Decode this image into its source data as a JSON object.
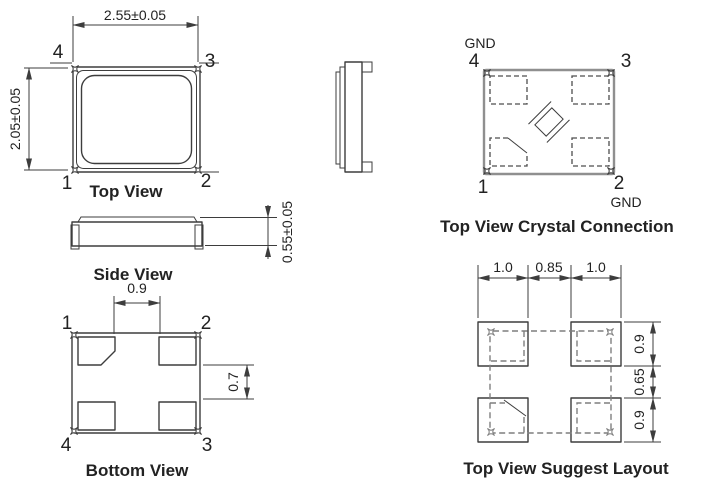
{
  "colors": {
    "line": "#3d3d3d",
    "gray_outline": "#8f8f8f",
    "text": "#222222",
    "background": "#ffffff"
  },
  "top_view": {
    "caption": "Top View",
    "width_dim": "2.55±0.05",
    "height_dim": "2.05±0.05",
    "pin_top_left": "4",
    "pin_top_right": "3",
    "pin_bottom_left": "1",
    "pin_bottom_right": "2"
  },
  "side_view": {
    "caption": "Side View",
    "thickness_dim": "0.55±0.05"
  },
  "bottom_view": {
    "caption": "Bottom View",
    "pad_gap_x_dim": "0.9",
    "pad_gap_y_dim": "0.7",
    "pin_top_left": "1",
    "pin_top_right": "2",
    "pin_bottom_left": "4",
    "pin_bottom_right": "3"
  },
  "crystal_connection": {
    "caption": "Top View Crystal Connection",
    "gnd_top_label": "GND",
    "gnd_bottom_label": "GND",
    "pin_top_left": "4",
    "pin_top_right": "3",
    "pin_bottom_left": "1",
    "pin_bottom_right": "2"
  },
  "suggest_layout": {
    "caption": "Top View Suggest Layout",
    "dim_left_pad_width": "1.0",
    "dim_pad_gap_x": "0.85",
    "dim_right_pad_width": "1.0",
    "dim_top_pad_height": "0.9",
    "dim_pad_gap_y": "0.65",
    "dim_bottom_pad_height": "0.9"
  }
}
